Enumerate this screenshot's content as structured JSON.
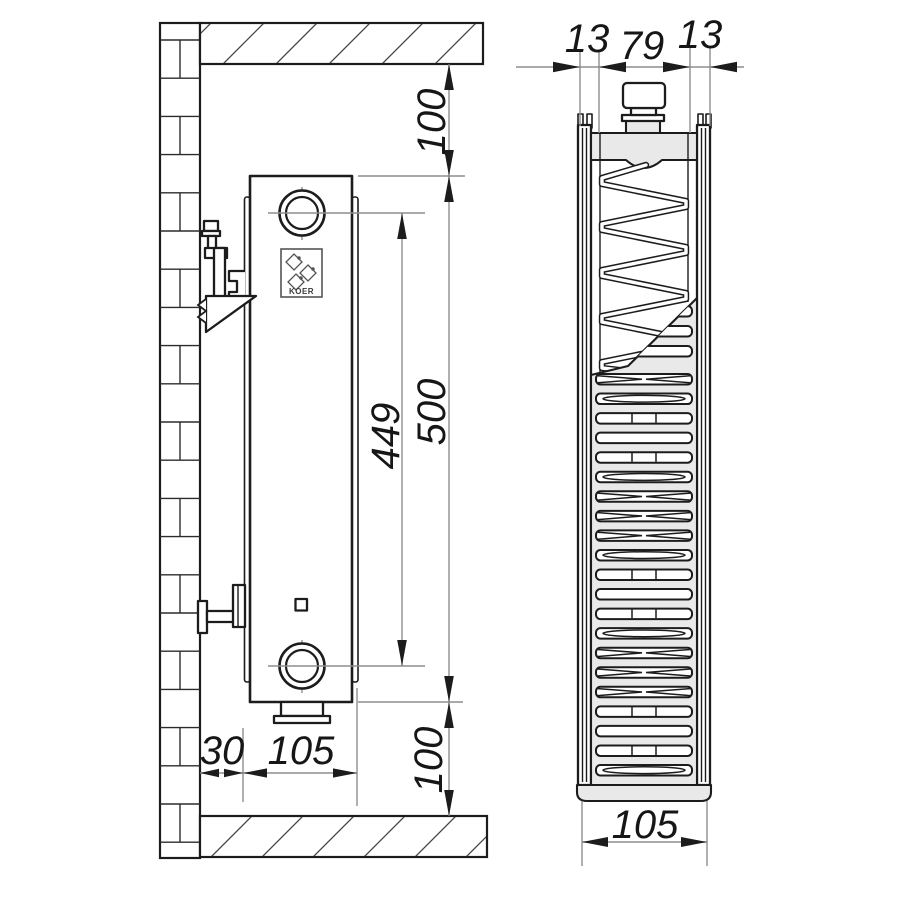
{
  "drawing": {
    "brand_logo_text": "KOER",
    "side_view": {
      "top_clearance_mm": "100",
      "port_spacing_mm": "449",
      "height_mm": "500",
      "wall_gap_mm": "30",
      "depth_mm": "105",
      "bottom_clearance_mm": "100"
    },
    "section_view": {
      "front_panel_mm": "13",
      "core_mm": "79",
      "rear_panel_mm": "13",
      "total_depth_mm": "105"
    },
    "style": {
      "line_color": "#1c1c1c",
      "dim_color": "#8e8e8e",
      "panel_fill": "#e9e9e9",
      "text_color": "#161616"
    }
  }
}
